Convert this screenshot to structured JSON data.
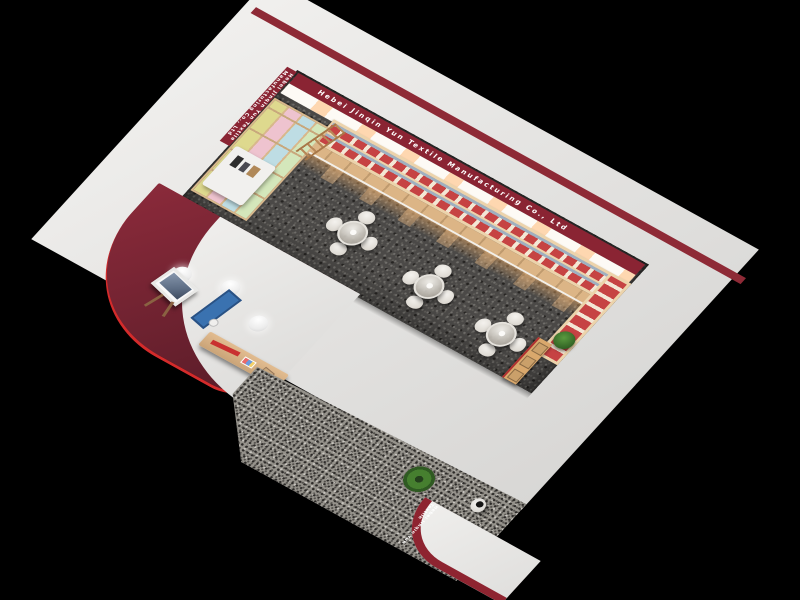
{
  "image": {
    "type": "3d-render",
    "description": "Bird's-eye cutaway 3D rendering of a textile company showroom: red company banner along the back wall, wall shelving stocked with red-and-white towel products, a pastel fabric-sample tile wall on the left, three round glass tables with four white chairs each on dark speckled carpet, a maroon-walled reception nook with easel picture, blue display board, pendant sphere lamps and a wooden desk, and a front walkway with potted plant, visitor figure and curved entrance canopy with red fascia signage, all on a black background."
  },
  "signage": {
    "banner_text": "Hebei Jinqin Yun Textile Manufacturing Co., Ltd",
    "banner_side_text": "Hebei Jinqin Yun Textile Manufacturing Co., Ltd",
    "entrance_text": "Hebei Jinqin Yun Textile Manufacturing Co., Ltd"
  },
  "palette": {
    "background": "#000000",
    "roof": "#e5e4e2",
    "banner_maroon": "#8a2433",
    "exterior_wall_maroon": "#6e2230",
    "red_trim": "#d42b2b",
    "wood": "#dcb586",
    "product_red": "#c64343",
    "carpet_showroom": "#4b4947",
    "carpet_walkway": "#96938c",
    "chair_white": "#eae7e2",
    "display_board_blue": "#3a72b0",
    "plant_green": "#467f2f"
  },
  "sample_tile_colors": [
    "#ded98e",
    "#eec3cf",
    "#bedde4",
    "#d4e7bb"
  ],
  "objects": {
    "tables": {
      "count": 3,
      "chairs_per_table": 4,
      "top": "round glass"
    },
    "pendant_lamps": {
      "count": 3
    },
    "plants": {
      "count": 2
    },
    "people": {
      "count": 1
    },
    "shelf_rows": {
      "count": 2
    }
  }
}
